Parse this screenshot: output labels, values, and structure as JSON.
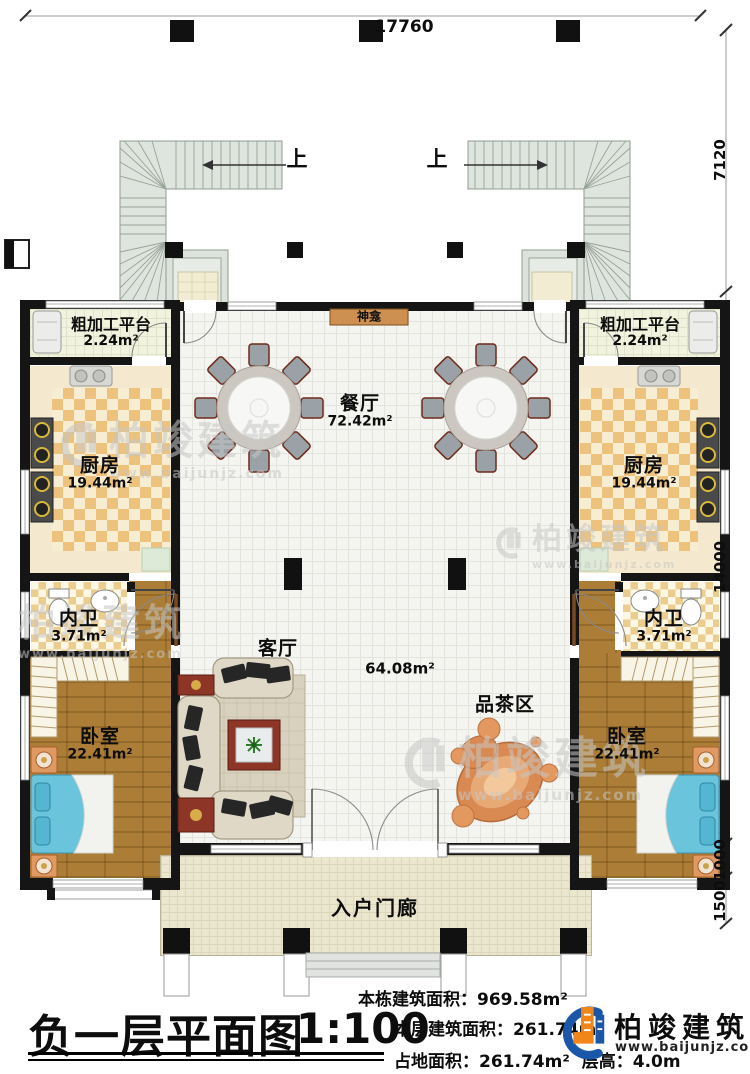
{
  "dims": {
    "top": "17760",
    "r1": "7120",
    "r2": "14000",
    "r3": "1000",
    "r4": "1500"
  },
  "stairs": {
    "up_left": "上",
    "up_right": "上"
  },
  "rooms": {
    "shrine": "神龛",
    "dining_name": "餐厅",
    "dining_area": "72.42m²",
    "platform_name": "粗加工平台",
    "platform_area": "2.24m²",
    "kitchen_name": "厨房",
    "kitchen_area": "19.44m²",
    "bath_name": "内卫",
    "bath_area": "3.71m²",
    "bedroom_name": "卧室",
    "bedroom_area": "22.41m²",
    "living_name": "客厅",
    "hall_area": "64.08m²",
    "tea_name": "品茶区",
    "porch_name": "入户门廊"
  },
  "watermark": {
    "brand": "柏竣建筑",
    "url": "www.baijunjz.com"
  },
  "titleblock": {
    "title": "负一层平面图",
    "scale": "1:100",
    "line1": "本栋建筑面积：969.58m²",
    "line2": "本层建筑面积：261.74m²",
    "line3a": "占地面积：261.74m²",
    "line3b": "层高：4.0m",
    "logo_brand": "柏竣建筑",
    "logo_url": "www.baijunjz.com"
  }
}
